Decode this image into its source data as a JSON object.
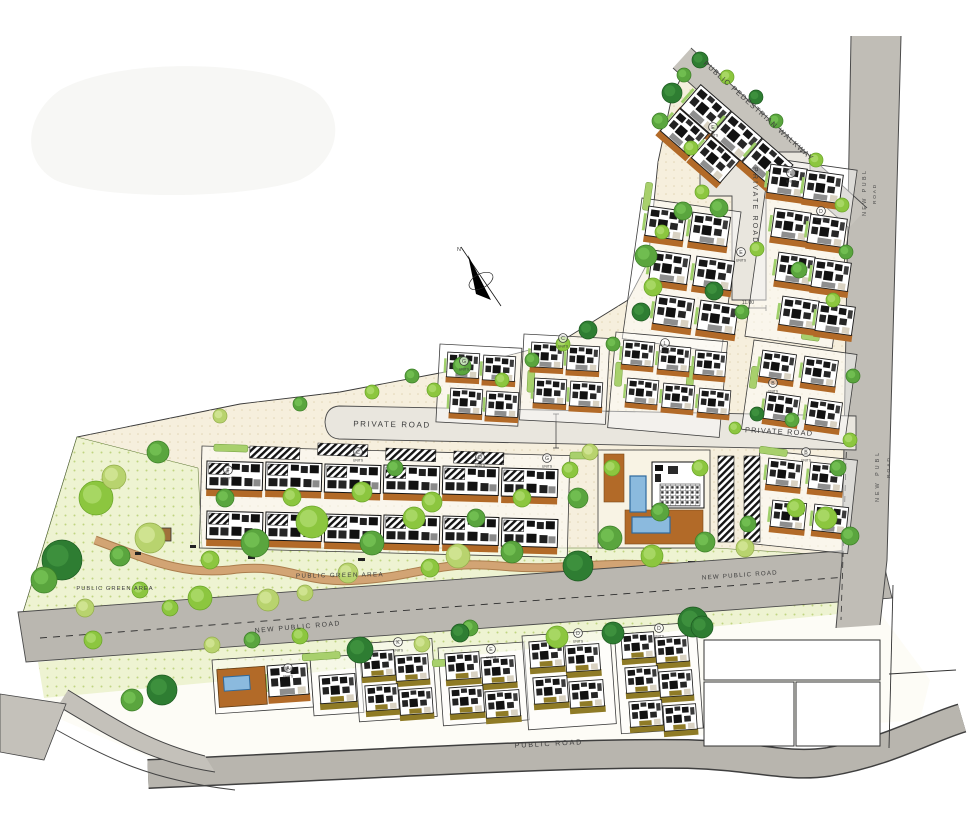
{
  "plan": {
    "type": "residential-masterplan-site-plan",
    "labels": {
      "pedestrian_walkway": "PUBLIC PEDESTRIAN WALKWAY",
      "private_road": "PRIVATE ROAD",
      "new_public_road": "NEW PUBLIC ROAD",
      "new_public_road_vertical_word1": "NEW PUBL",
      "new_public_road_vertical_word2": "ROAD",
      "public_green_area": "PUBLIC GREEN AREA",
      "public_road": "PUBLIC ROAD",
      "north_letter": "N",
      "dimension_label": "11.00",
      "units_caption": "UNITS"
    },
    "unit_markers": [
      {
        "letter": "E",
        "x": 713,
        "y": 127
      },
      {
        "letter": "L",
        "x": 791,
        "y": 173
      },
      {
        "letter": "D",
        "x": 821,
        "y": 211
      },
      {
        "letter": "E",
        "x": 741,
        "y": 252
      },
      {
        "letter": "B",
        "x": 773,
        "y": 383
      },
      {
        "letter": "G",
        "x": 464,
        "y": 361
      },
      {
        "letter": "C",
        "x": 563,
        "y": 338
      },
      {
        "letter": "L",
        "x": 665,
        "y": 343
      },
      {
        "letter": "C",
        "x": 358,
        "y": 452
      },
      {
        "letter": "D",
        "x": 480,
        "y": 457
      },
      {
        "letter": "G",
        "x": 547,
        "y": 458
      },
      {
        "letter": "F",
        "x": 228,
        "y": 470
      },
      {
        "letter": "A",
        "x": 288,
        "y": 668
      },
      {
        "letter": "K",
        "x": 398,
        "y": 642
      },
      {
        "letter": "E",
        "x": 491,
        "y": 649
      },
      {
        "letter": "D",
        "x": 578,
        "y": 633
      },
      {
        "letter": "D",
        "x": 659,
        "y": 628
      },
      {
        "letter": "B",
        "x": 806,
        "y": 452
      }
    ],
    "colors": {
      "public_road_gray": "#bfbcb5",
      "internal_road": "#e9e6de",
      "site_cream": "#f6efdd",
      "green_area": "#eef3d2",
      "tree_dark": "#2e7d32",
      "tree_mid": "#5aa53e",
      "tree_light": "#8cc63f",
      "tree_yellow": "#b8d36e",
      "terrace_brown": "#b26a28",
      "terrace_olive": "#8f7b26",
      "pool_blue": "#8bbade",
      "path_tan": "#d2a474"
    }
  }
}
